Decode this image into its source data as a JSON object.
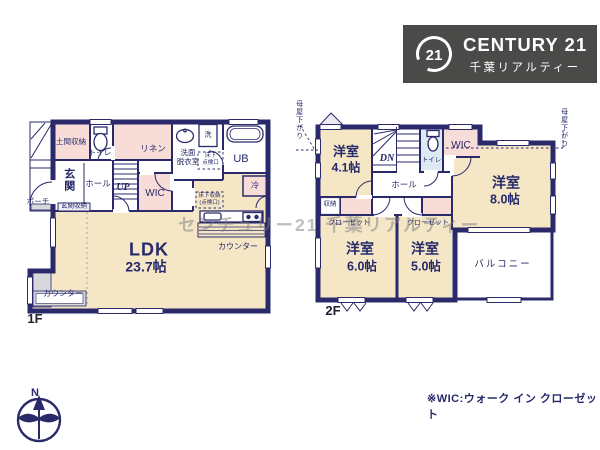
{
  "watermark": "センチュリー21 千葉リアルティー",
  "logo": {
    "seal": "21",
    "brand": "CENTURY 21",
    "company": "千葉リアルティー"
  },
  "compass": {
    "north": "N"
  },
  "footnote": "※WIC:ウォーク イン クローゼット",
  "floor1": {
    "label": "1F",
    "rooms": {
      "ldk": {
        "name": "LDK",
        "size": "23.7帖"
      },
      "entrance": "玄関",
      "hall": "ホール",
      "porch": "ポーチ",
      "doma_storage": "土間収納",
      "entrance_storage": "玄関収納",
      "toilet": "トイレ",
      "linen": "リネン",
      "wic": "WIC",
      "stairs_up": "UP",
      "washroom": [
        "洗面",
        "脱衣室"
      ],
      "washer": "洗",
      "bath": "UB",
      "fridge": "冷",
      "underfloor_hatch": [
        "床下",
        "点検口"
      ],
      "underfloor_storage": [
        "床下収納",
        "(点検口)"
      ],
      "kitchen_counter": "カウンター",
      "window_counter": "カウンター"
    }
  },
  "floor2": {
    "label": "2F",
    "rooms": {
      "bedroom_41": {
        "name": "洋室",
        "size": "4.1帖"
      },
      "bedroom_80": {
        "name": "洋室",
        "size": "8.0帖"
      },
      "bedroom_60": {
        "name": "洋室",
        "size": "6.0帖"
      },
      "bedroom_50": {
        "name": "洋室",
        "size": "5.0帖"
      },
      "stairs_down": "DN",
      "hall": "ホール",
      "toilet": "トイレ",
      "wic": "WIC",
      "storage": "収納",
      "closet_left": "クローゼット",
      "closet_right": "クローゼット",
      "balcony": "バルコニー"
    },
    "sloped_left": "母屋下がり",
    "sloped_right": "母屋下がり"
  },
  "colors": {
    "wall": "#2a2a6a",
    "room_cream": "#f5e7c6",
    "room_pink": "#f8dcd8",
    "toilet_blue": "#dde9f3",
    "counter_gray": "#d8d8dc",
    "logo_bg": "#4a4a48"
  }
}
